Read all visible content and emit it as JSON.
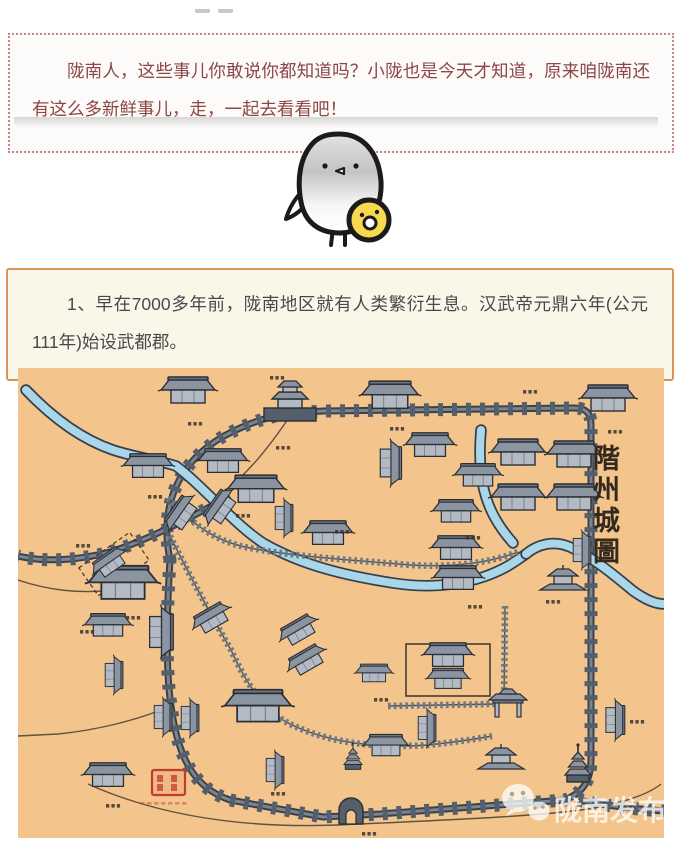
{
  "page": {
    "background": "#ffffff"
  },
  "intro_box": {
    "text": "陇南人，这些事儿你敢说你都知道吗？小陇也是今天才知道，原来咱陇南还有这么多新鲜事儿，走，一起去看看吧！",
    "text_color": "#8d4646",
    "border_color": "#cb8383",
    "background": "#fdfafa"
  },
  "mascot": {
    "description": "white-round-bird-holding-yellow-chick",
    "outline": "#1b1b1b",
    "body_fill": "#ffffff",
    "body_shade": "#c6c6c6",
    "chick_fill": "#f7d84e"
  },
  "fact_box": {
    "text": "1、早在7000多年前，陇南地区就有人类繁衍生息。汉武帝元鼎六年(公元111年)始设武都郡。",
    "text_color": "#45494e",
    "border_color": "#d79455",
    "background": "#fbf7e8"
  },
  "map": {
    "title": "階州城圖",
    "title_color": "#33291e",
    "background": "#f3c48c",
    "palette": {
      "wall": "#545f6b",
      "wall_dark": "#39424c",
      "wall_light": "#7b8591",
      "river_fill": "#a9d6e8",
      "river_edge": "#37404a",
      "road": "#6e7884",
      "road_edge": "#4a525c",
      "roof": "#8b95a2",
      "roof_dark": "#6d7683",
      "bodyc": "#b3bac4",
      "edge": "#2b2f35",
      "ink": "#3b352e",
      "seal": "#c23b2e"
    },
    "watermark": {
      "text": "陇南发布",
      "icon": "wechat-chat-bubbles-icon",
      "color": "rgba(253,252,250,0.78)"
    },
    "walls": {
      "main": "M 152,192 C 141,138 160,94 206,68 C 243,48 266,45 305,43 L 556,40 C 569,40 573,46 573,57 L 573,390 C 573,412 566,424 547,432 L 362,446 L 305,449 L 212,432 C 176,420 160,390 153,338 C 147,297 149,240 152,192 Z",
      "spur_nw": "M 212,128 C 172,150 130,172 92,184 C 58,193 25,194 0,188",
      "spur_se": "M 560,432 C 590,438 615,441 646,443"
    },
    "outlines": [
      "M 70,416 C 150,452 240,460 320,457 C 430,452 530,448 576,440 C 612,433 632,425 643,416",
      "M 0,212 C 30,222 60,226 95,222",
      "M 153,338 C 120,352 80,362 40,366 L 0,368",
      "M 272,48 C 252,78 230,105 208,122"
    ],
    "rivers": [
      "M 8,22 C 30,45 60,70 95,82 C 120,90 140,92 158,98 C 185,118 215,155 245,175 C 285,198 330,208 375,215 C 420,222 460,215 490,198 C 500,192 505,188 508,186",
      "M 463,62 C 461,85 462,105 466,122 C 471,142 480,158 495,175",
      "M 508,186 C 520,176 536,172 552,179 C 576,190 596,207 614,222 C 630,234 640,236 646,236"
    ],
    "roads": [
      "M 150,130 C 178,160 200,174 232,180 C 280,189 335,192 392,197 C 442,200 476,193 500,184",
      "M 152,168 C 172,208 190,242 213,282 C 228,315 245,342 272,356 C 315,377 365,380 410,377 C 438,374 458,371 474,368",
      "M 487,238 L 486,334",
      "M 370,338 L 478,336"
    ],
    "halls": [
      [
        170,
        28,
        44
      ],
      [
        372,
        33,
        46
      ],
      [
        590,
        36,
        44
      ],
      [
        130,
        103,
        40
      ],
      [
        205,
        98,
        40
      ],
      [
        238,
        127,
        46
      ],
      [
        412,
        82,
        40
      ],
      [
        460,
        112,
        38
      ],
      [
        500,
        90,
        44
      ],
      [
        556,
        92,
        44
      ],
      [
        500,
        135,
        44
      ],
      [
        556,
        135,
        44
      ],
      [
        310,
        170,
        40
      ],
      [
        105,
        222,
        56
      ],
      [
        438,
        148,
        38
      ],
      [
        438,
        185,
        40
      ],
      [
        440,
        215,
        40
      ],
      [
        90,
        262,
        38
      ],
      [
        240,
        345,
        54
      ],
      [
        90,
        412,
        40
      ],
      [
        368,
        382,
        36
      ],
      [
        356,
        309,
        30
      ],
      [
        430,
        292,
        40
      ],
      [
        430,
        315,
        34
      ]
    ],
    "vert_halls": [
      [
        368,
        95,
        36
      ],
      [
        262,
        150,
        30
      ],
      [
        560,
        182,
        30
      ],
      [
        138,
        264,
        40
      ],
      [
        92,
        307,
        30
      ],
      [
        141,
        349,
        30
      ],
      [
        168,
        350,
        30
      ],
      [
        253,
        402,
        30
      ],
      [
        405,
        360,
        30
      ],
      [
        593,
        352,
        32
      ]
    ],
    "rotated_halls": [
      [
        167,
        148,
        34,
        -55
      ],
      [
        206,
        142,
        34,
        -55
      ],
      [
        94,
        198,
        32,
        -35
      ],
      [
        196,
        254,
        34,
        -30
      ],
      [
        283,
        266,
        34,
        -30
      ],
      [
        291,
        296,
        34,
        -30
      ]
    ],
    "gate_tower": [
      272,
      40
    ],
    "pagodas": [
      [
        560,
        412,
        1
      ],
      [
        335,
        400,
        0.7
      ]
    ],
    "pavilions": [
      [
        483,
        392
      ],
      [
        545,
        213
      ]
    ],
    "paifang": [
      490,
      337
    ],
    "south_gate_arch": [
      333,
      449
    ],
    "courtyard": [
      388,
      276,
      84,
      52
    ],
    "dashed_plot": {
      "x": 96,
      "y": 196,
      "rot": -35,
      "w": 62,
      "h": 34
    },
    "label_marks": [
      [
        170,
        54
      ],
      [
        372,
        59
      ],
      [
        505,
        22
      ],
      [
        590,
        62
      ],
      [
        130,
        127
      ],
      [
        58,
        176
      ],
      [
        252,
        8
      ],
      [
        258,
        78
      ],
      [
        218,
        146
      ],
      [
        448,
        168
      ],
      [
        450,
        237
      ],
      [
        317,
        162
      ],
      [
        108,
        248
      ],
      [
        62,
        262
      ],
      [
        356,
        330
      ],
      [
        612,
        352
      ],
      [
        88,
        436
      ],
      [
        528,
        232
      ],
      [
        600,
        437
      ],
      [
        344,
        464
      ],
      [
        253,
        424
      ]
    ],
    "seal": {
      "x": 134,
      "y": 402,
      "w": 33,
      "h": 25
    }
  }
}
